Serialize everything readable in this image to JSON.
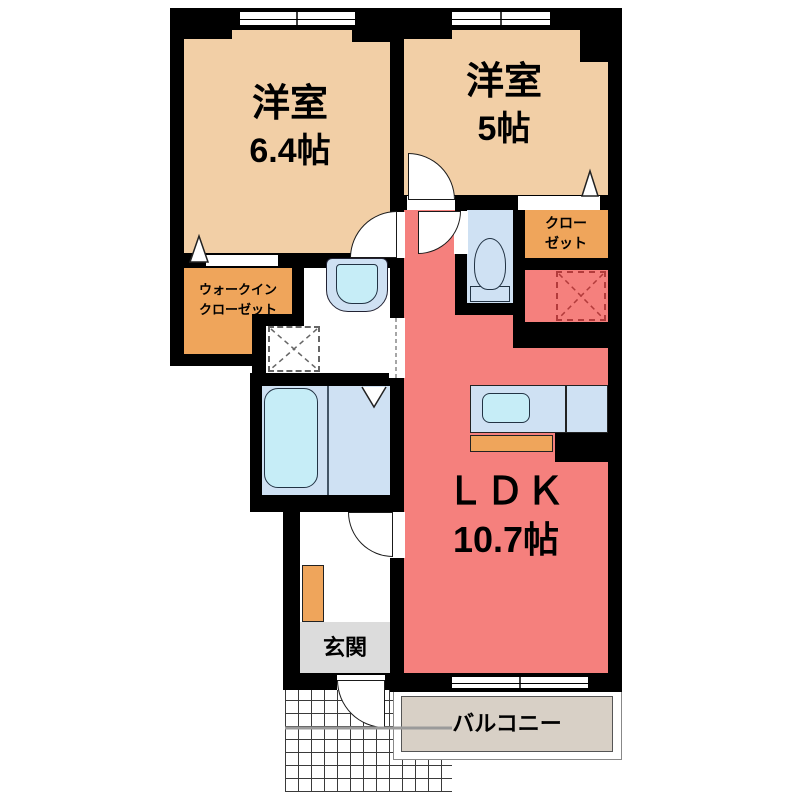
{
  "floorplan": {
    "title": "1LDK apartment floor plan",
    "rooms": {
      "bedroom1": {
        "name": "洋室",
        "size": "6.4帖"
      },
      "bedroom2": {
        "name": "洋室",
        "size": "5帖"
      },
      "ldk": {
        "name": "ＬＤＫ",
        "size": "10.7帖"
      },
      "closet": {
        "line1": "クロー",
        "line2": "ゼット"
      },
      "walk_in_closet": {
        "line1": "ウォークイン",
        "line2": "クローゼット"
      },
      "entrance": {
        "name": "玄関"
      },
      "balcony": {
        "name": "バルコニー"
      }
    },
    "colors": {
      "wall": "#000000",
      "bedroom": "#f2cfa6",
      "closetOrange": "#efa55b",
      "ldkPink": "#f5807d",
      "wetBlue": "#cfe1f3",
      "fixtureCyan": "#c6edf7",
      "entranceGray": "#dcdcdc",
      "balconyTaupe": "#d8d0c6",
      "fridgeDash": "#b23b3b",
      "applianceDash": "#666666"
    }
  }
}
